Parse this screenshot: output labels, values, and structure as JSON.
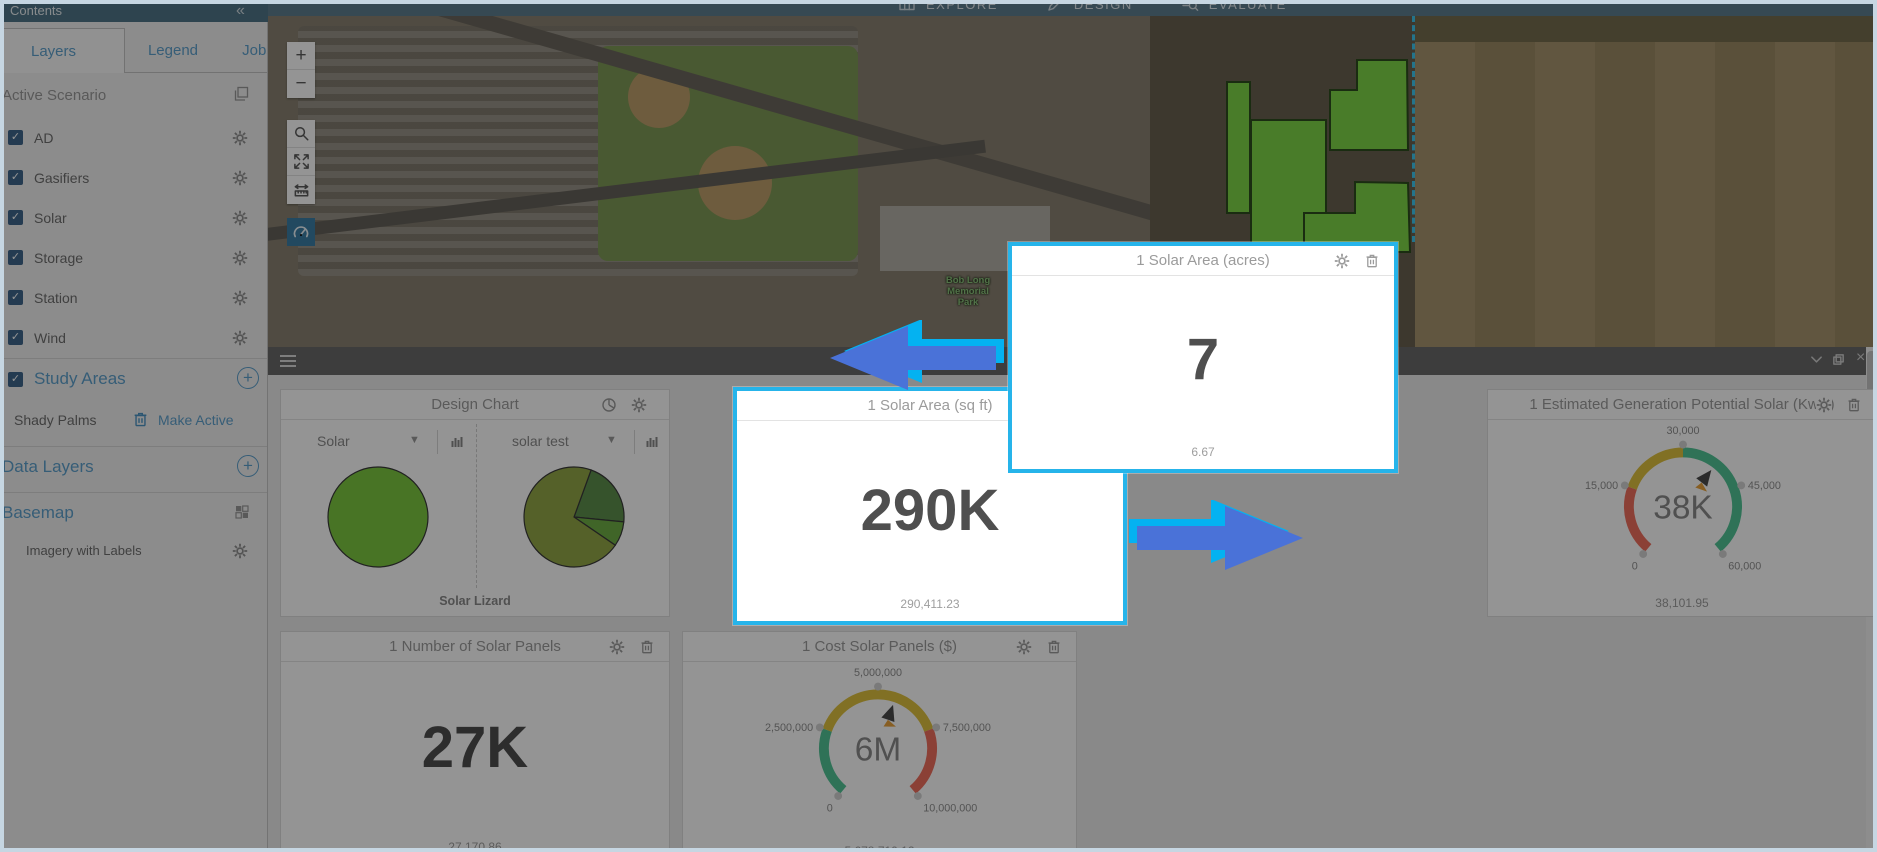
{
  "topbar": {
    "contents_title": "Contents",
    "collapse_glyph": "«",
    "menu": [
      {
        "label": "EXPLORE"
      },
      {
        "label": "DESIGN"
      },
      {
        "label": "EVALUATE"
      }
    ]
  },
  "sidebar": {
    "tabs": [
      {
        "label": "Layers"
      },
      {
        "label": "Legend"
      },
      {
        "label": "Jobs"
      }
    ],
    "active_scenario_label": "Active Scenario",
    "scenario_layers": [
      {
        "label": "AD"
      },
      {
        "label": "Gasifiers"
      },
      {
        "label": "Solar"
      },
      {
        "label": "Storage"
      },
      {
        "label": "Station"
      },
      {
        "label": "Wind"
      }
    ],
    "study_areas_label": "Study Areas",
    "study_area_item": {
      "name": "Shady Palms",
      "action_label": "Make Active"
    },
    "data_layers_label": "Data Layers",
    "basemap_label": "Basemap",
    "basemap_item_label": "Imagery with Labels",
    "check_glyph": "✓"
  },
  "map": {
    "zoom_in_glyph": "+",
    "zoom_out_glyph": "−",
    "park_label_lines": [
      "Bob Long",
      "Memorial",
      "Park"
    ]
  },
  "dashboard": {
    "close_glyph": "×"
  },
  "chart_data": [
    {
      "id": "design_chart",
      "type": "pie",
      "title": "Design Chart",
      "caption": "Solar Lizard",
      "charts": [
        {
          "selector": "Solar",
          "categories": [
            "Solar"
          ],
          "values": [
            100
          ],
          "colors": [
            "#7cc840"
          ],
          "start_angle": 0
        },
        {
          "selector": "solar test",
          "categories": [
            "slice-1",
            "slice-2",
            "slice-3"
          ],
          "values": [
            21,
            8,
            71
          ],
          "colors": [
            "#5d8f4c",
            "#6fae45",
            "#93a847"
          ],
          "start_angle": 20
        }
      ]
    },
    {
      "id": "solar_area_sqft",
      "type": "number",
      "title": "1 Solar Area (sq ft)",
      "display_value": "290K",
      "exact_value": "290,411.23",
      "highlighted": true
    },
    {
      "id": "solar_area_acres",
      "type": "number",
      "title": "1 Solar Area (acres)",
      "display_value": "7",
      "exact_value": "6.67",
      "highlighted": true
    },
    {
      "id": "est_generation_potential",
      "type": "gauge",
      "title": "1 Estimated Generation Potential Solar (KwH)",
      "display_value": "38K",
      "exact_value": "38,101.95",
      "value": 38101.95,
      "min": 0,
      "max": 60000,
      "tick_labels": [
        "0",
        "15,000",
        "30,000",
        "45,000",
        "60,000"
      ],
      "zones": [
        {
          "from": 0,
          "to": 15000,
          "color": "#ef6e5e"
        },
        {
          "from": 15000,
          "to": 30000,
          "color": "#dfc13f"
        },
        {
          "from": 30000,
          "to": 60000,
          "color": "#52c496"
        }
      ]
    },
    {
      "id": "number_of_solar_panels",
      "type": "number",
      "title": "1 Number of Solar Panels",
      "display_value": "27K",
      "exact_value": "27,170.86"
    },
    {
      "id": "cost_solar_panels",
      "type": "gauge",
      "title": "1 Cost Solar Panels ($)",
      "display_value": "6M",
      "exact_value": "5,678,710.12",
      "value": 5678710.12,
      "min": 0,
      "max": 10000000,
      "tick_labels": [
        "0",
        "2,500,000",
        "5,000,000",
        "7,500,000",
        "10,000,000"
      ],
      "zones": [
        {
          "from": 0,
          "to": 2500000,
          "color": "#52c496"
        },
        {
          "from": 2500000,
          "to": 7500000,
          "color": "#dfc13f"
        },
        {
          "from": 7500000,
          "to": 10000000,
          "color": "#ef6e5e"
        }
      ]
    }
  ]
}
